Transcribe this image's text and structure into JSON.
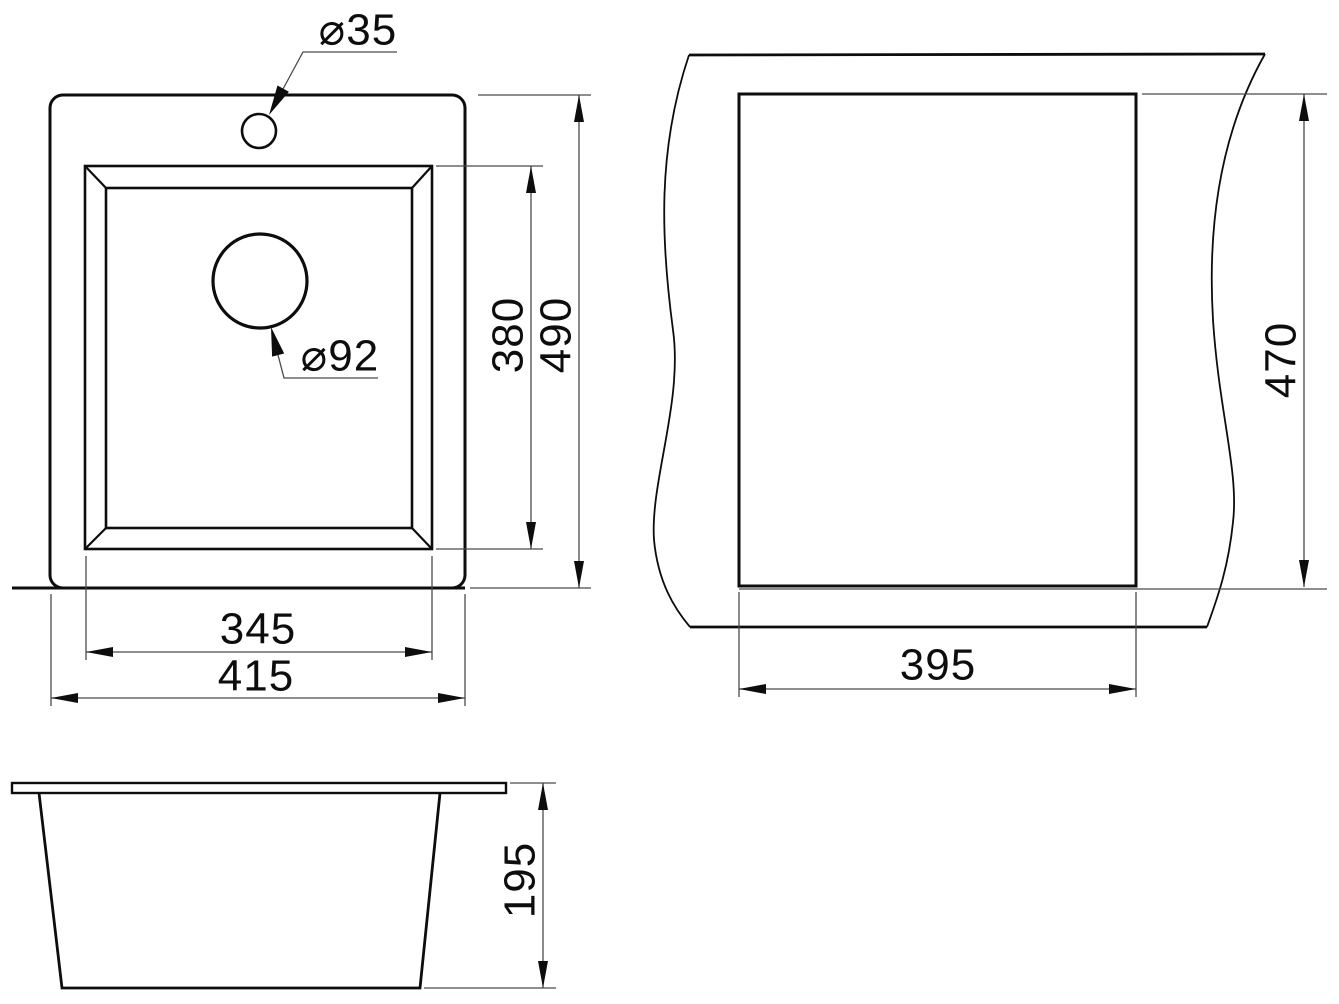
{
  "document": {
    "type": "technical-dimension-drawing",
    "subject": "kitchen sink with faucet hole, drain hole, countertop cutout and side profile",
    "units_implied": "mm",
    "colors": {
      "background": "#ffffff",
      "object_line": "#0d0d0d",
      "dimension_line": "#4a4a4a",
      "text": "#0d0d0d"
    }
  },
  "diagram": {
    "top_view": {
      "faucet_hole_label": "⌀35",
      "drain_hole_label": "⌀92",
      "bowl_width": "345",
      "overall_width": "415",
      "bowl_depth": "380",
      "overall_depth": "490"
    },
    "cutout_view": {
      "cutout_width": "395",
      "cutout_depth": "470"
    },
    "front_view": {
      "bowl_height": "195"
    }
  }
}
